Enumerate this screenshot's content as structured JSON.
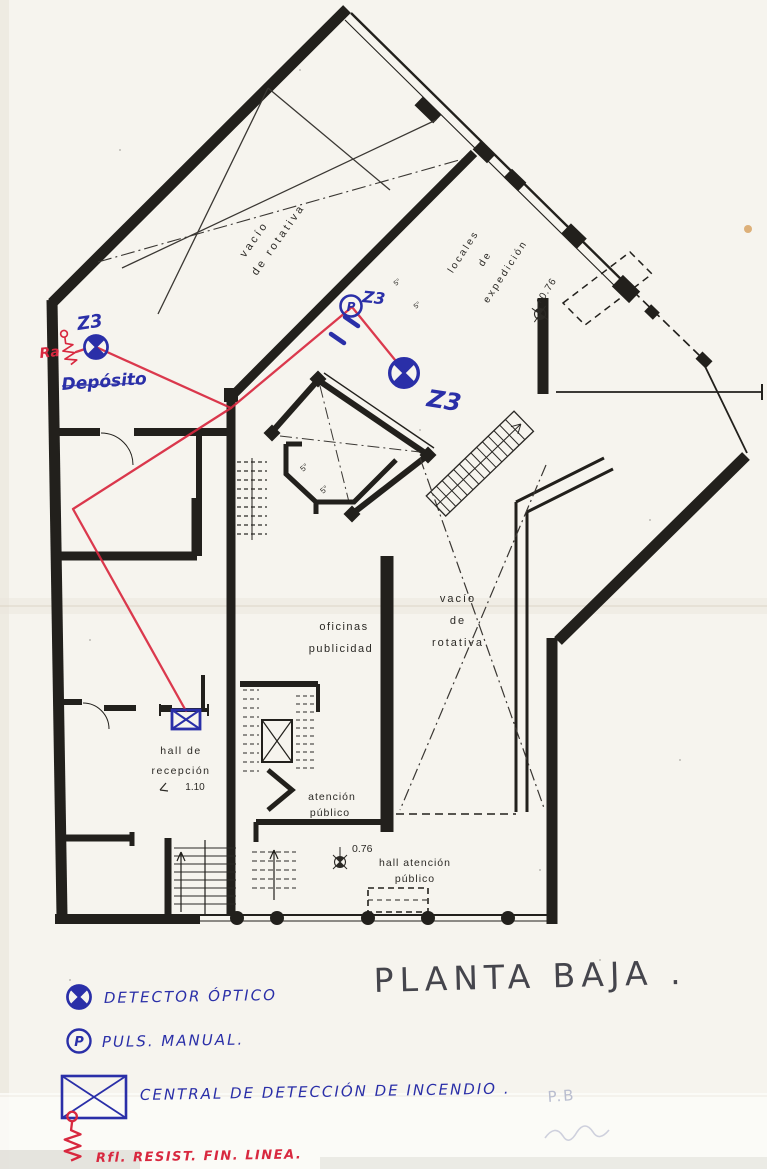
{
  "title": {
    "text": "PLANTA  BAJA ."
  },
  "plan_labels": {
    "vacio_tl_line1": "vacío",
    "vacio_tl_line2": "de  rotativa",
    "locales_line1": "locales",
    "locales_line2": "de",
    "locales_line3": "expedición",
    "level_expedicion": "+0.76",
    "vacio_mid_line1": "vacío",
    "vacio_mid_line2": "de",
    "vacio_mid_line3": "rotativa",
    "oficinas_line1": "oficinas",
    "oficinas_line2": "publicidad",
    "hall_recepcion_line1": "hall  de",
    "hall_recepcion_line2": "recepción",
    "hall_recepcion_level": "1.10",
    "atencion_line1": "atención",
    "atencion_line2": "público",
    "hall_atencion_level": "0.76",
    "hall_atencion_line1": "hall atención",
    "hall_atencion_line2": "público",
    "room_number_a": "5°",
    "room_number_b": "5°",
    "room_number_c": "5°",
    "room_number_d": "5°"
  },
  "handwritten": {
    "zone_label_deposito_area": "Z3",
    "zone_label_pulsador": "Z3",
    "zone_label_detector2": "Z3",
    "deposito": "Depósito",
    "resistor_mark": "Ra",
    "pulsador_letter": "P"
  },
  "legend": {
    "detector_label": "DETECTOR ÓPTICO",
    "pulsador_letter": "P",
    "pulsador_label": "PULS. MANUAL.",
    "central_label": "CENTRAL  DE  DETECCIÓN  DE  INCENDIO .",
    "resistor_label": "Rfl.   RESIST. FIN. LINEA."
  },
  "pencil_notes": {
    "note": "P.B"
  },
  "colors": {
    "paper": "#f6f4ee",
    "ink": "#22201c",
    "blue_ink": "#2a2fa8",
    "red_ink": "#d8283f",
    "pencil": "#b9bdcf"
  }
}
